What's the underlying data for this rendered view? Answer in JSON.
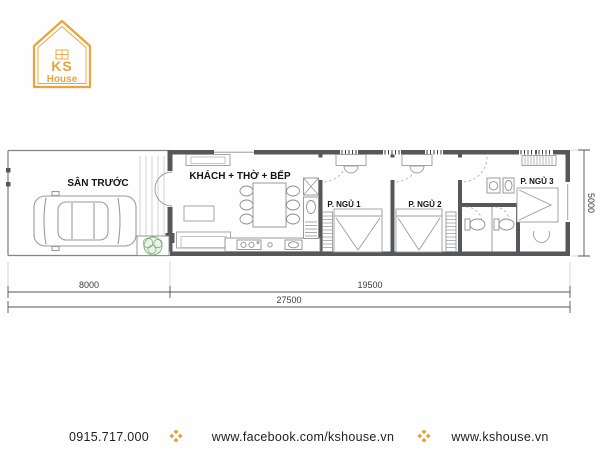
{
  "logo": {
    "brand_top": "KS",
    "brand_bottom": "House",
    "color": "#E9A43C"
  },
  "plan": {
    "room_labels": {
      "front_yard": "SÂN TRƯỚC",
      "living_kitchen": "KHÁCH + THỜ + BẾP",
      "bedroom_1": "P. NGỦ 1",
      "bedroom_2": "P. NGỦ 2",
      "bedroom_3": "P. NGỦ 3"
    },
    "dimensions": {
      "front_yard_width": "8000",
      "house_length": "19500",
      "total_length": "27500",
      "plot_depth": "5000"
    }
  },
  "footer": {
    "phone": "0915.717.000",
    "facebook_url": "www.facebook.com/kshouse.vn",
    "website_url": "www.kshouse.vn"
  },
  "colors": {
    "accent_gold": "#E9A43C",
    "wall": "#54585a",
    "furniture_line": "#9b9b9b",
    "dimension_line": "#555555"
  }
}
